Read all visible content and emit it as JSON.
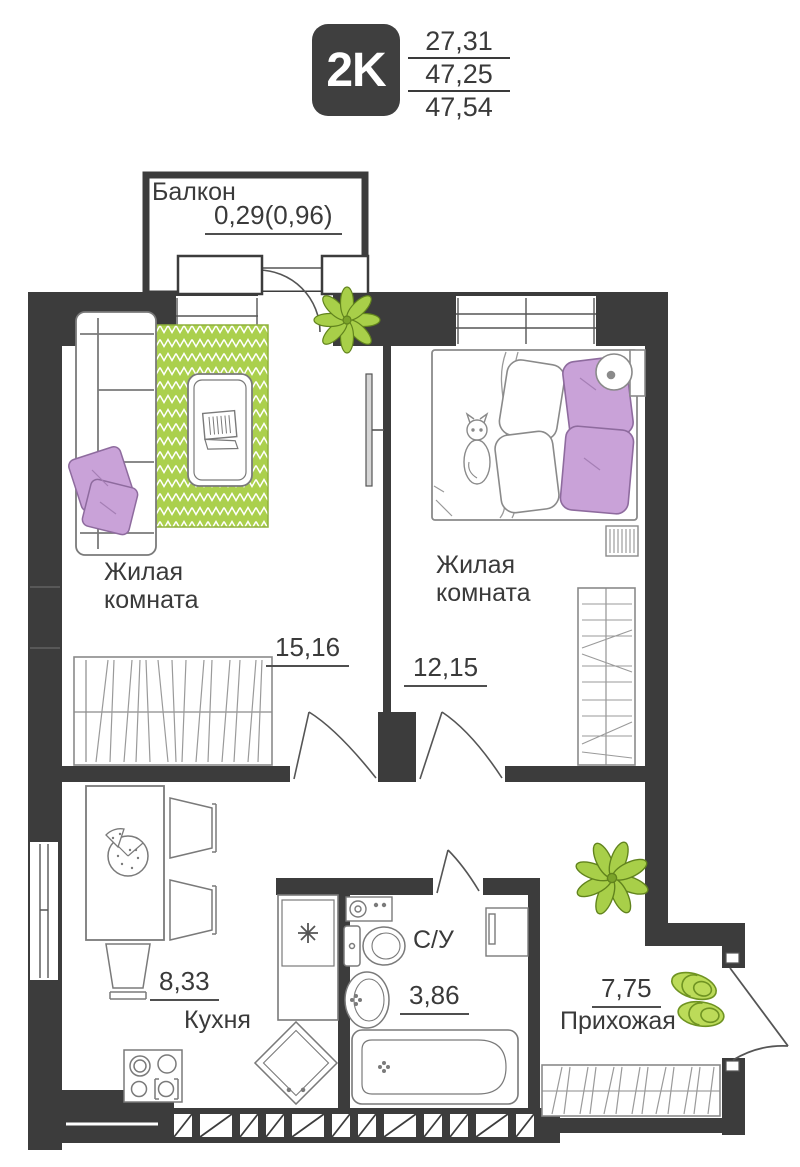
{
  "header": {
    "badge": "2K",
    "value_top": "27,31",
    "value_middle": "47,25",
    "value_bottom": "47,54"
  },
  "balcony": {
    "label": "Балкон",
    "area": "0,29(0,96)"
  },
  "rooms": {
    "living_room_1": {
      "label": "Жилая комната",
      "area": "15,16"
    },
    "living_room_2": {
      "label": "Жилая комната",
      "area": "12,15"
    },
    "kitchen": {
      "label": "Кухня",
      "area": "8,33"
    },
    "bathroom": {
      "label": "С/У",
      "area": "3,86"
    },
    "hallway": {
      "label": "Прихожая",
      "area": "7,75"
    }
  },
  "colors": {
    "wall": "#3c3c3c",
    "accent_green": "#abd04d",
    "accent_purple": "#c9a2d8",
    "text": "#3a3a3a"
  },
  "icons": {
    "plant": "plant-icon",
    "slippers": "slippers-icon",
    "pizza": "pizza-icon",
    "cat": "cat-icon"
  }
}
